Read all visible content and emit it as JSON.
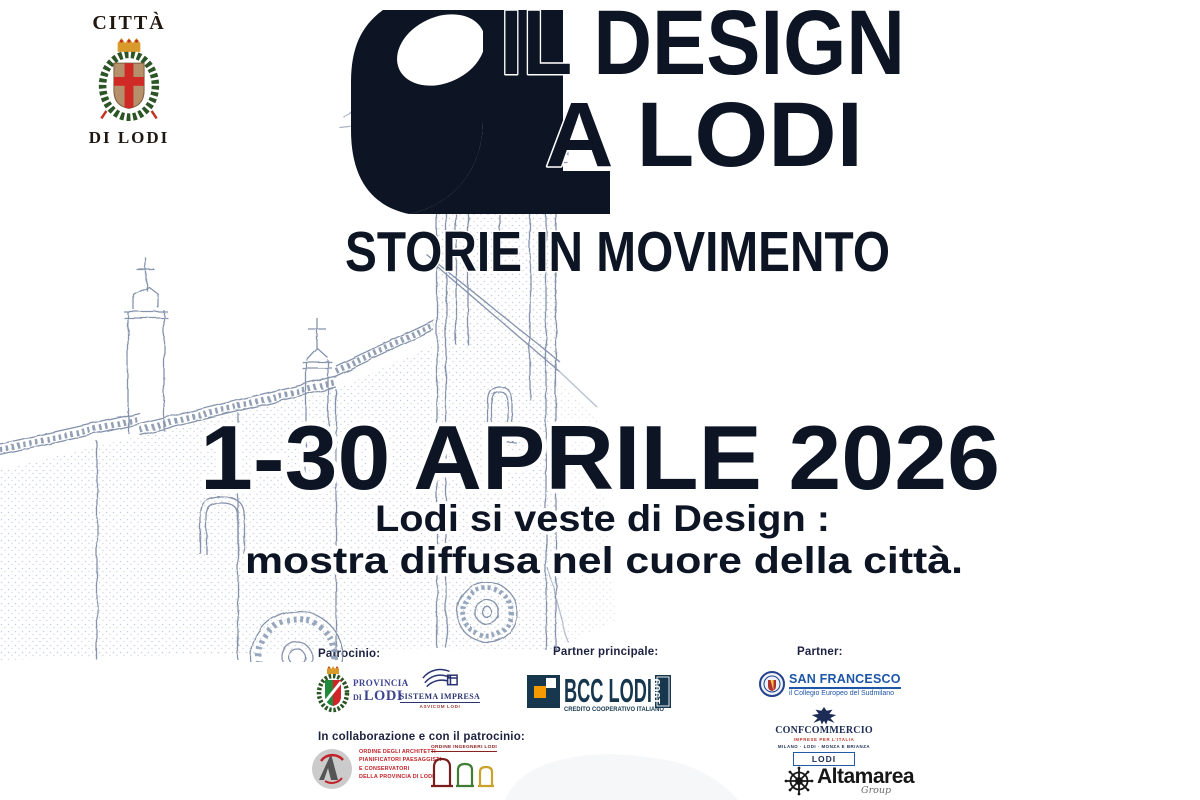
{
  "city_logo": {
    "line1": "CITTÀ",
    "line2": "DI LODI"
  },
  "title": {
    "line1": "IL DESIGN",
    "line2": "A LODI",
    "subtitle": "STORIE IN MOVIMENTO"
  },
  "hero": {
    "date": "1-30 APRILE 2026",
    "tagline1": "Lodi si veste di Design :",
    "tagline2": "mostra diffusa nel cuore della città."
  },
  "footer": {
    "patrocinio": {
      "label": "Patrocinio:",
      "provincia": {
        "name_top": "PROVINCIA",
        "name_prefix": "DI",
        "name_main": "LODI"
      },
      "sistema": {
        "name": "SISTEMA IMPRESA",
        "sub": "ASVICOM LODI"
      }
    },
    "partner_principale": {
      "label": "Partner principale:",
      "bcc": {
        "name": "BCC LODI",
        "tagline": "CREDITO COOPERATIVO ITALIANO",
        "year": "1909"
      }
    },
    "partner": {
      "label": "Partner:",
      "san_francesco": {
        "name": "SAN FRANCESCO",
        "sub": "il Collegio Europeo del Sudmilano"
      },
      "confcommercio": {
        "name": "CONFCOMMERCIO",
        "sub1": "IMPRESE PER L'ITALIA",
        "sub2": "MILANO · LODI · MONZA E BRIANZA",
        "badge": "LODI"
      },
      "altamarea": {
        "name": "Altamarea",
        "sub": "Group"
      }
    },
    "collaborazione": {
      "label": "In collaborazione e con il patrocinio:",
      "architetti": {
        "lines": [
          "ORDINE DEGLI ARCHITETTI",
          "PIANIFICATORI PAESAGGISTI",
          "E CONSERVATORI",
          "DELLA PROVINCIA DI LODI"
        ]
      },
      "ingegneri": {
        "name": "ORDINE INGEGNERI LODI"
      }
    }
  },
  "colors": {
    "ink": "#0d1524",
    "sketch": "#7b8aa6",
    "bcc_navy": "#16374e",
    "bcc_orange": "#f59a00",
    "red": "#c22127",
    "blue": "#1d55a8",
    "navy": "#1d2c56",
    "green": "#1f8a3c"
  }
}
